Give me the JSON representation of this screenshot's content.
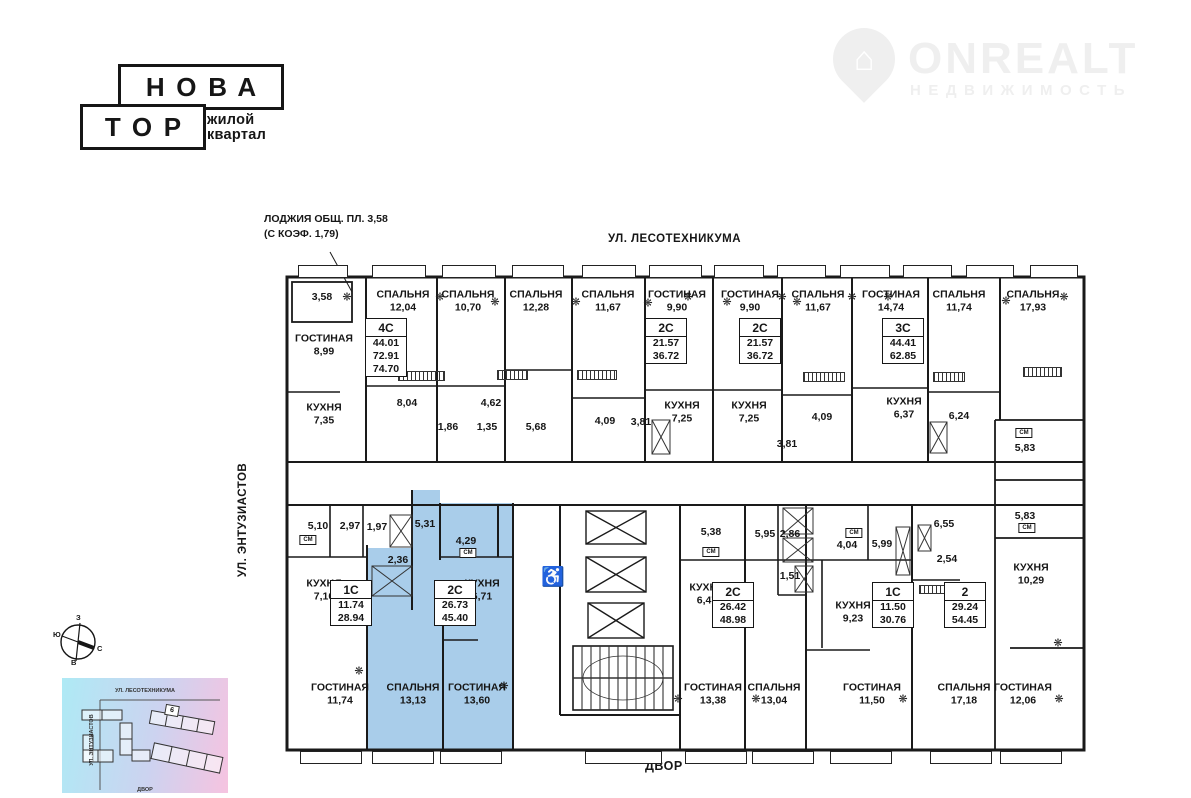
{
  "brand": {
    "logo_line1": "НОВА",
    "logo_line2": "ТОР",
    "tagline_line1": "жилой",
    "tagline_line2": "квартал"
  },
  "watermark": {
    "name": "ONREALT",
    "subtitle": "НЕДВИЖИМОСТЬ",
    "house_icon": "⌂"
  },
  "annotation": {
    "line1": "ЛОДЖИЯ ОБЩ. ПЛ. 3,58",
    "line2": "(С КОЭФ. 1,79)"
  },
  "streets": {
    "top": "УЛ. ЛЕСОТЕХНИКУМА",
    "left": "УЛ. ЭНТУЗИАСТОВ",
    "yard": "ДВОР"
  },
  "compass": {
    "top": "З",
    "left": "Ю",
    "right": "С",
    "bottom": "В"
  },
  "minimap": {
    "street_top": "УЛ. ЛЕСОТЕХНИКУМА",
    "street_left": "УЛ. ЭНТУЗИАСТОВ",
    "street_bottom": "ДВОР",
    "building_label": "6"
  },
  "colors": {
    "highlight": "#a9cdea",
    "walls": "#1a1a1a",
    "watermark": "#efefef"
  },
  "plan": {
    "sm_label": "СМ",
    "wheelchair_icon": "♿",
    "snowflake_icon": "❋",
    "rooms": [
      {
        "name": "ГОСТИНАЯ",
        "area": "8,99"
      },
      {
        "name": "КУХНЯ",
        "area": "7,35"
      },
      {
        "name": "СПАЛЬНЯ",
        "area": "12,04"
      },
      {
        "name": "СПАЛЬНЯ",
        "area": "10,70"
      },
      {
        "name": "СПАЛЬНЯ",
        "area": "12,28"
      },
      {
        "name": "СПАЛЬНЯ",
        "area": "11,67"
      },
      {
        "name": "ГОСТИНАЯ",
        "area": "9,90"
      },
      {
        "name": "ГОСТИНАЯ",
        "area": "9,90"
      },
      {
        "name": "КУХНЯ",
        "area": "7,25"
      },
      {
        "name": "КУХНЯ",
        "area": "7,25"
      },
      {
        "name": "СПАЛЬНЯ",
        "area": "11,67"
      },
      {
        "name": "ГОСТИНАЯ",
        "area": "14,74"
      },
      {
        "name": "КУХНЯ",
        "area": "6,37"
      },
      {
        "name": "СПАЛЬНЯ",
        "area": "11,74"
      },
      {
        "name": "СПАЛЬНЯ",
        "area": "17,93"
      },
      {
        "name": "КУХНЯ",
        "area": "10,29"
      },
      {
        "name": "КУХНЯ",
        "area": "7,16"
      },
      {
        "name": "КУХНЯ",
        "area": "6,71"
      },
      {
        "name": "ГОСТИНАЯ",
        "area": "11,74"
      },
      {
        "name": "СПАЛЬНЯ",
        "area": "13,13"
      },
      {
        "name": "ГОСТИНАЯ",
        "area": "13,60"
      },
      {
        "name": "КУХНЯ",
        "area": "6,47"
      },
      {
        "name": "ГОСТИНАЯ",
        "area": "13,38"
      },
      {
        "name": "СПАЛЬНЯ",
        "area": "13,04"
      },
      {
        "name": "КУХНЯ",
        "area": "9,23"
      },
      {
        "name": "ГОСТИНАЯ",
        "area": "11,50"
      },
      {
        "name": "СПАЛЬНЯ",
        "area": "17,18"
      },
      {
        "name": "ГОСТИНАЯ",
        "area": "12,06"
      }
    ],
    "areas": [
      "3,58",
      "8,04",
      "4,62",
      "1,86",
      "1,35",
      "5,68",
      "4,09",
      "3,81",
      "3,81",
      "4,09",
      "6,24",
      "5,83",
      "5,83",
      "5,10",
      "2,97",
      "1,97",
      "5,31",
      "4,29",
      "2,36",
      "5,38",
      "5,95",
      "2,86",
      "1,51",
      "4,04",
      "5,99",
      "6,55",
      "2,54"
    ],
    "badges": [
      {
        "type": "4С",
        "line1": "44.01",
        "line2": "72.91",
        "line3": "74.70"
      },
      {
        "type": "2С",
        "line1": "21.57",
        "line2": "36.72"
      },
      {
        "type": "2С",
        "line1": "21.57",
        "line2": "36.72"
      },
      {
        "type": "3С",
        "line1": "44.41",
        "line2": "62.85"
      },
      {
        "type": "1С",
        "line1": "11.74",
        "line2": "28.94"
      },
      {
        "type": "2С",
        "line1": "26.73",
        "line2": "45.40"
      },
      {
        "type": "2С",
        "line1": "26.42",
        "line2": "48.98"
      },
      {
        "type": "1С",
        "line1": "11.50",
        "line2": "30.76"
      },
      {
        "type": "2",
        "line1": "29.24",
        "line2": "54.45"
      }
    ]
  }
}
